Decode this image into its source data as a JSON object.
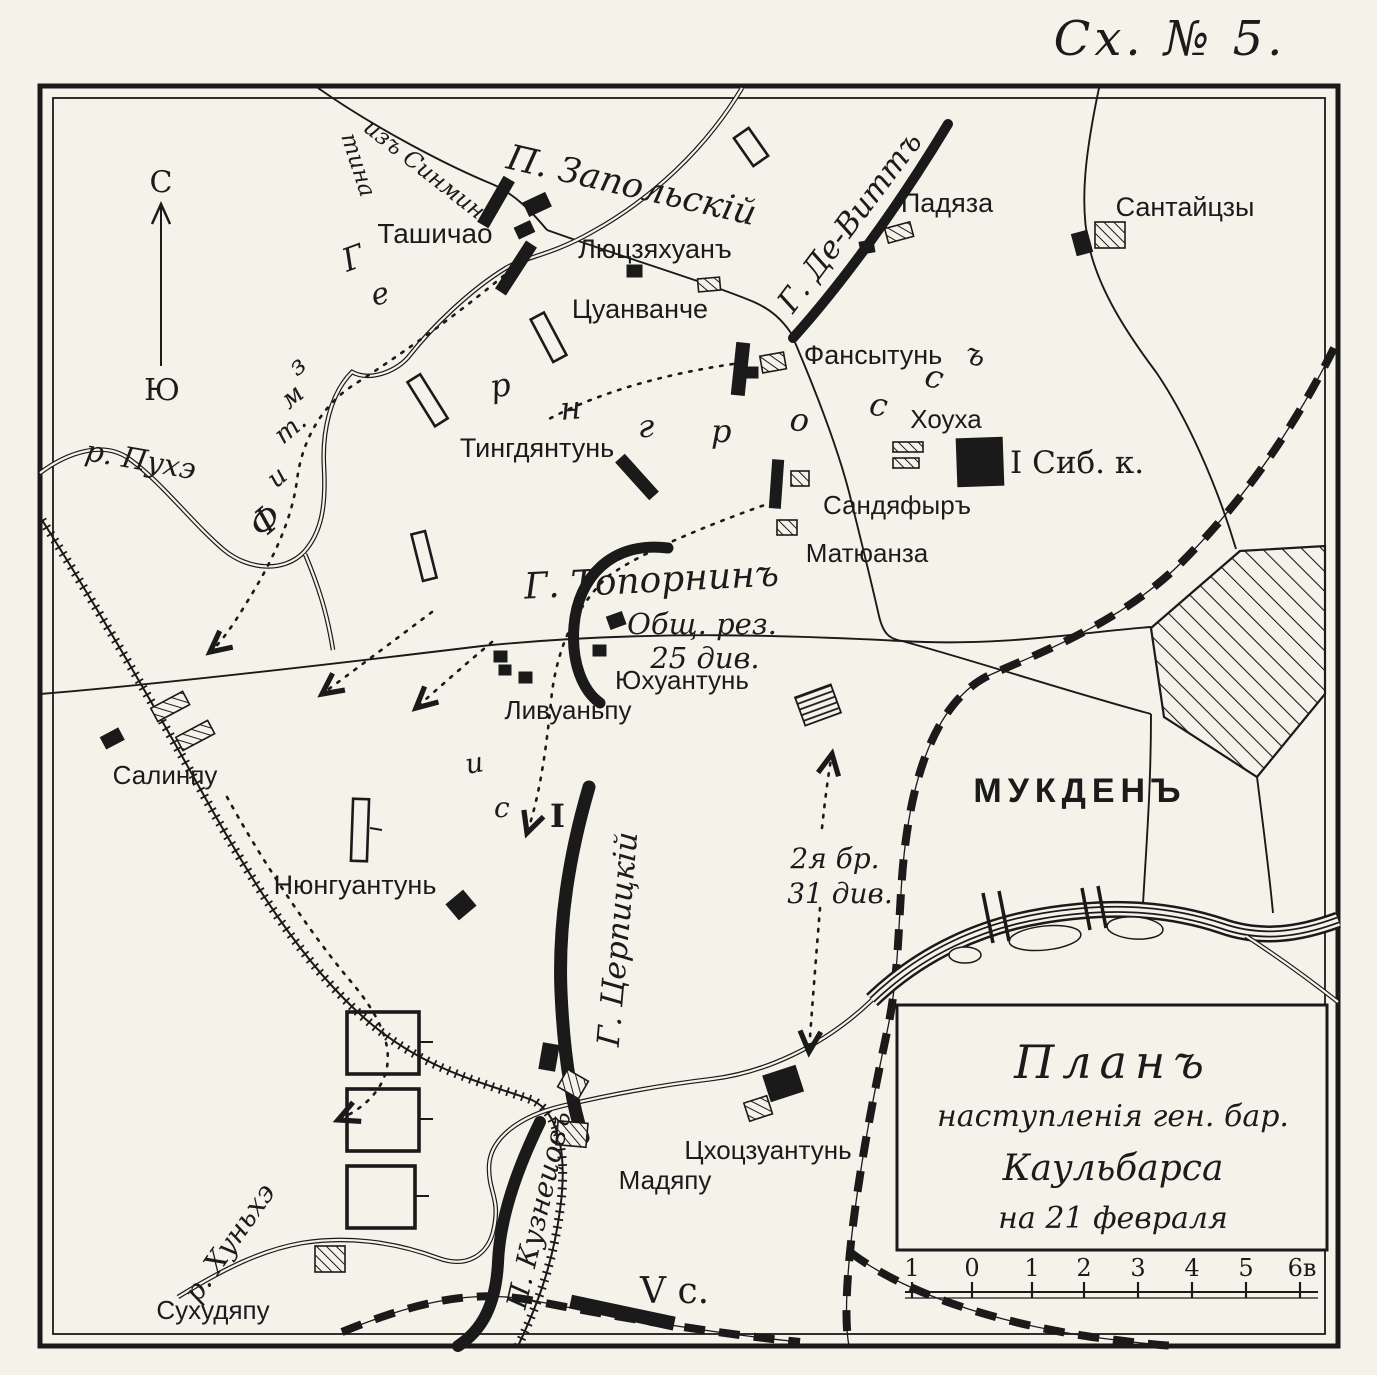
{
  "header": {
    "schema_no": "Сх. № 5."
  },
  "compass": {
    "north": "С",
    "south": "Ю"
  },
  "rivers": {
    "puhe": "р. Пухэ",
    "hunhe": "р. Хуньхэ"
  },
  "roads": {
    "sinmintin_part1": "изъ Синмин-",
    "sinmintin_part2": "тина"
  },
  "columns": {
    "zapolsky": "П. Запольскій",
    "dewitt": "Г. Де-Виттъ",
    "toporin": "Г. Топорнинъ",
    "toporin_note1": "Общ. рез.",
    "toporin_note2": "25 див.",
    "tserpitsky": "Г. Церпицкій",
    "kuznetsov": "П. Кузнецовъ",
    "brigade_note1": "2я бр.",
    "brigade_note2": "31 див.",
    "sib_corps": "I Сиб. к.",
    "v_corps": "V с."
  },
  "places": {
    "tashichao": "Ташичао",
    "lyutszyakhuan": "Люцзяхуанъ",
    "tsuanvanche": "Цуанванче",
    "padyaza": "Падяза",
    "santaitszy": "Сантайцзы",
    "fansytun": "Фансытунь",
    "tingdyantun": "Тингдянтунь",
    "khoukha": "Хоуха",
    "sandyafyr": "Сандяфыръ",
    "matyuanza": "Матюанза",
    "yukhuantun": "Юхуантунь",
    "livuanpu": "Ливуаньпу",
    "salinpu": "Салинпу",
    "nyunguantun": "Нюнгуантунь",
    "mukden": "МУКДЕНЪ",
    "tskhotszuantun": "Цхоцзуантунь",
    "madyapu": "Мадяпу",
    "sukhudyapu": "Сухудяпу"
  },
  "letters": {
    "gerngross": [
      "Г",
      "е",
      "р",
      "н",
      "г",
      "р",
      "о",
      "с",
      "с",
      "ъ"
    ],
    "west_route": [
      "з",
      "м",
      "т.",
      "и",
      "Ф"
    ],
    "center_route": [
      "и",
      "с",
      "I"
    ]
  },
  "legend": {
    "line1": "Планъ",
    "line2": "наступленія ген. бар.",
    "line3": "Каульбарса",
    "line4": "на 21 февраля"
  },
  "scale": {
    "ticks": [
      "1",
      "0",
      "1",
      "2",
      "3",
      "4",
      "5",
      "6в"
    ]
  }
}
